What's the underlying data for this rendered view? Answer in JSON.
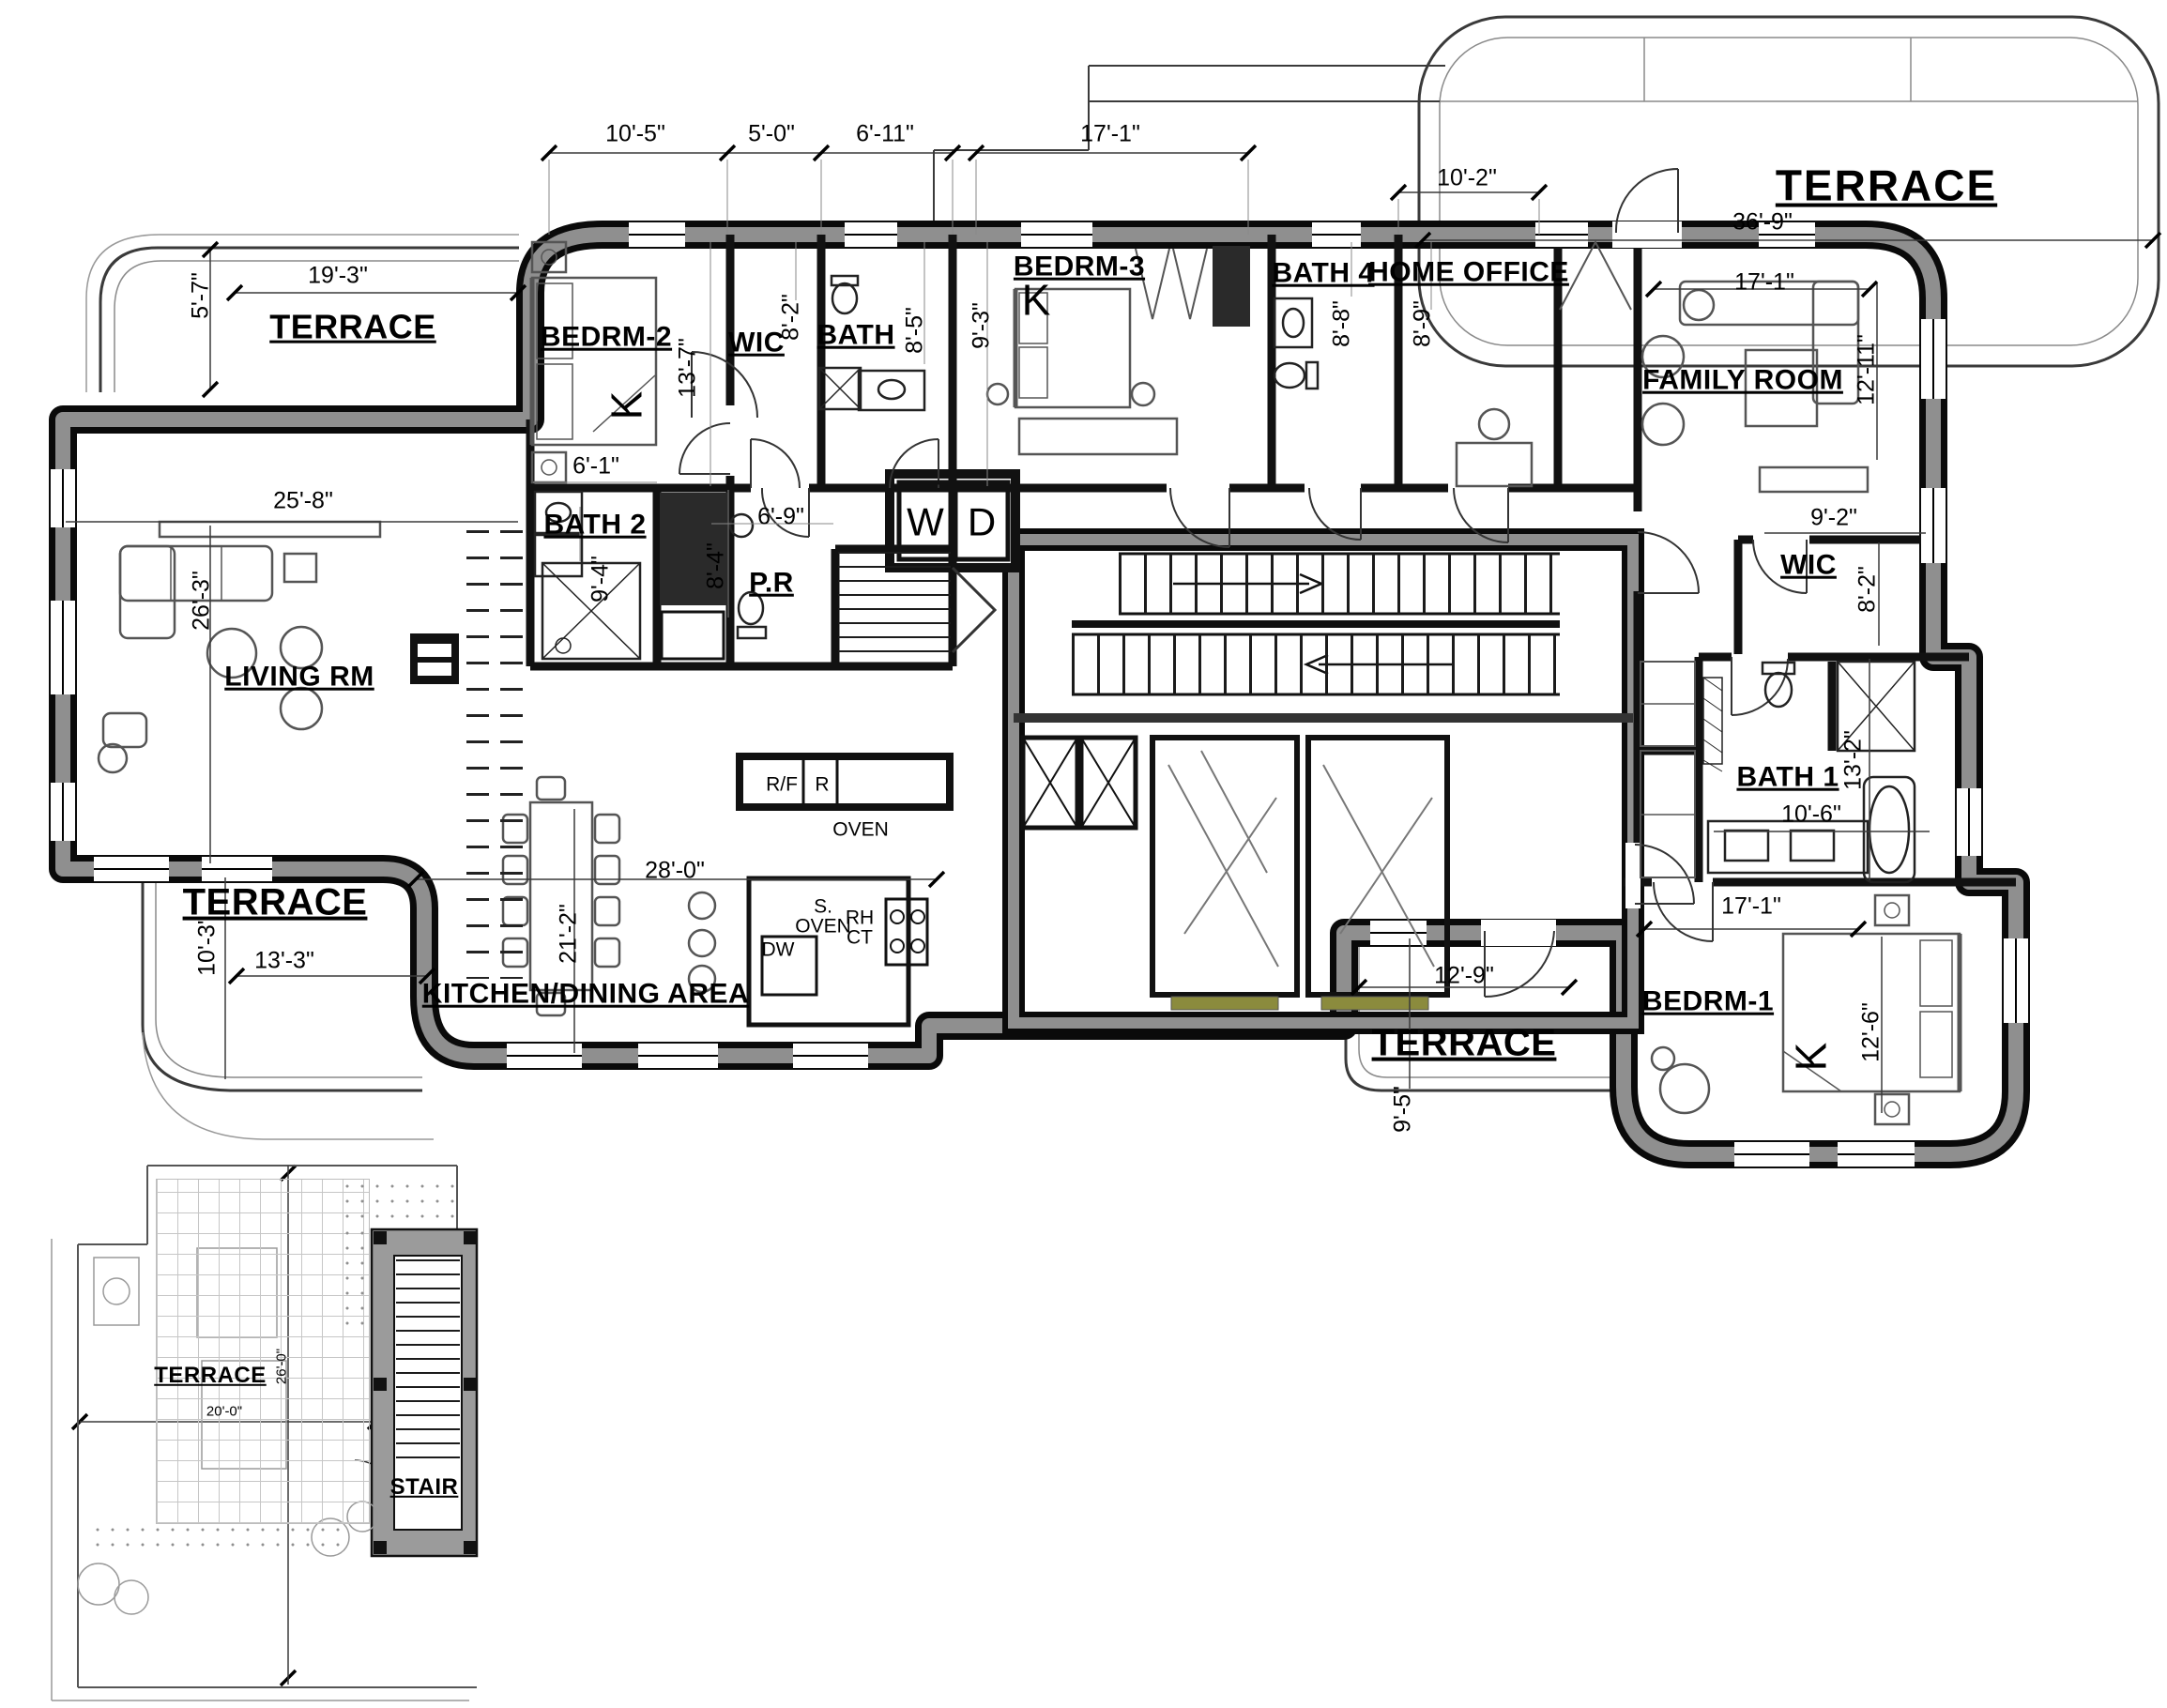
{
  "plan": {
    "dims_top": {
      "d1": "10'-5\"",
      "d2": "5'-0\"",
      "d3": "6'-11\"",
      "d4": "17'-1\"",
      "d5": "10'-2\""
    },
    "terrace_top_right": {
      "label": "TERRACE",
      "width": "36'-9\""
    },
    "terrace_upper_left": {
      "label": "TERRACE",
      "width": "19'-3\"",
      "depth": "5'-7\""
    },
    "terrace_lower_left": {
      "label": "TERRACE",
      "width": "13'-3\"",
      "depth": "10'-3\""
    },
    "terrace_bottom": {
      "label": "TERRACE",
      "width": "12'-9\"",
      "depth": "9'-5\""
    },
    "living_room": {
      "label": "LIVING RM",
      "width": "25'-8\"",
      "depth": "26'-3\""
    },
    "bedroom2": {
      "label": "BEDRM-2",
      "bed": "K",
      "depth": "13'-7\"",
      "closet_width": "6'-1\""
    },
    "wic2": {
      "label": "WIC",
      "depth": "8'-2\""
    },
    "bath3": {
      "label": "BATH",
      "depth": "8'-5\""
    },
    "bedroom3": {
      "label": "BEDRM-3",
      "bed": "K",
      "depth": "9'-3\""
    },
    "bath4": {
      "label": "BATH 4",
      "depth": "8'-8\""
    },
    "home_office": {
      "label": "HOME OFFICE",
      "depth": "8'-9\""
    },
    "family_room": {
      "label": "FAMILY ROOM",
      "width": "17'-1\"",
      "depth": "12'-11\""
    },
    "wic1": {
      "label": "WIC",
      "width": "9'-2\"",
      "depth": "8'-2\""
    },
    "bath1": {
      "label": "BATH 1",
      "depth": "13'-2\"",
      "width": "10'-6\""
    },
    "bedroom1": {
      "label": "BEDRM-1",
      "bed": "K",
      "width": "17'-1\"",
      "depth": "12'-6\""
    },
    "bath2": {
      "label": "BATH 2",
      "depth": "9'-4\""
    },
    "powder_room": {
      "label": "P.R",
      "width": "6'-9\"",
      "depth": "8'-4\""
    },
    "kitchen": {
      "label": "KITCHEN/DINING AREA",
      "width": "28'-0\"",
      "depth": "21'-2\"",
      "appliances": {
        "rf": "R/F",
        "r": "R",
        "oven": "OVEN",
        "s_oven": "S.\nOVEN",
        "rh_ct": "RH\nCT",
        "dw": "DW"
      }
    },
    "laundry": {
      "washer": "W",
      "dryer": "D"
    },
    "inset": {
      "terrace": "TERRACE",
      "stair": "STAIR",
      "depth": "26'-0\"",
      "width": "20'-0\""
    }
  }
}
